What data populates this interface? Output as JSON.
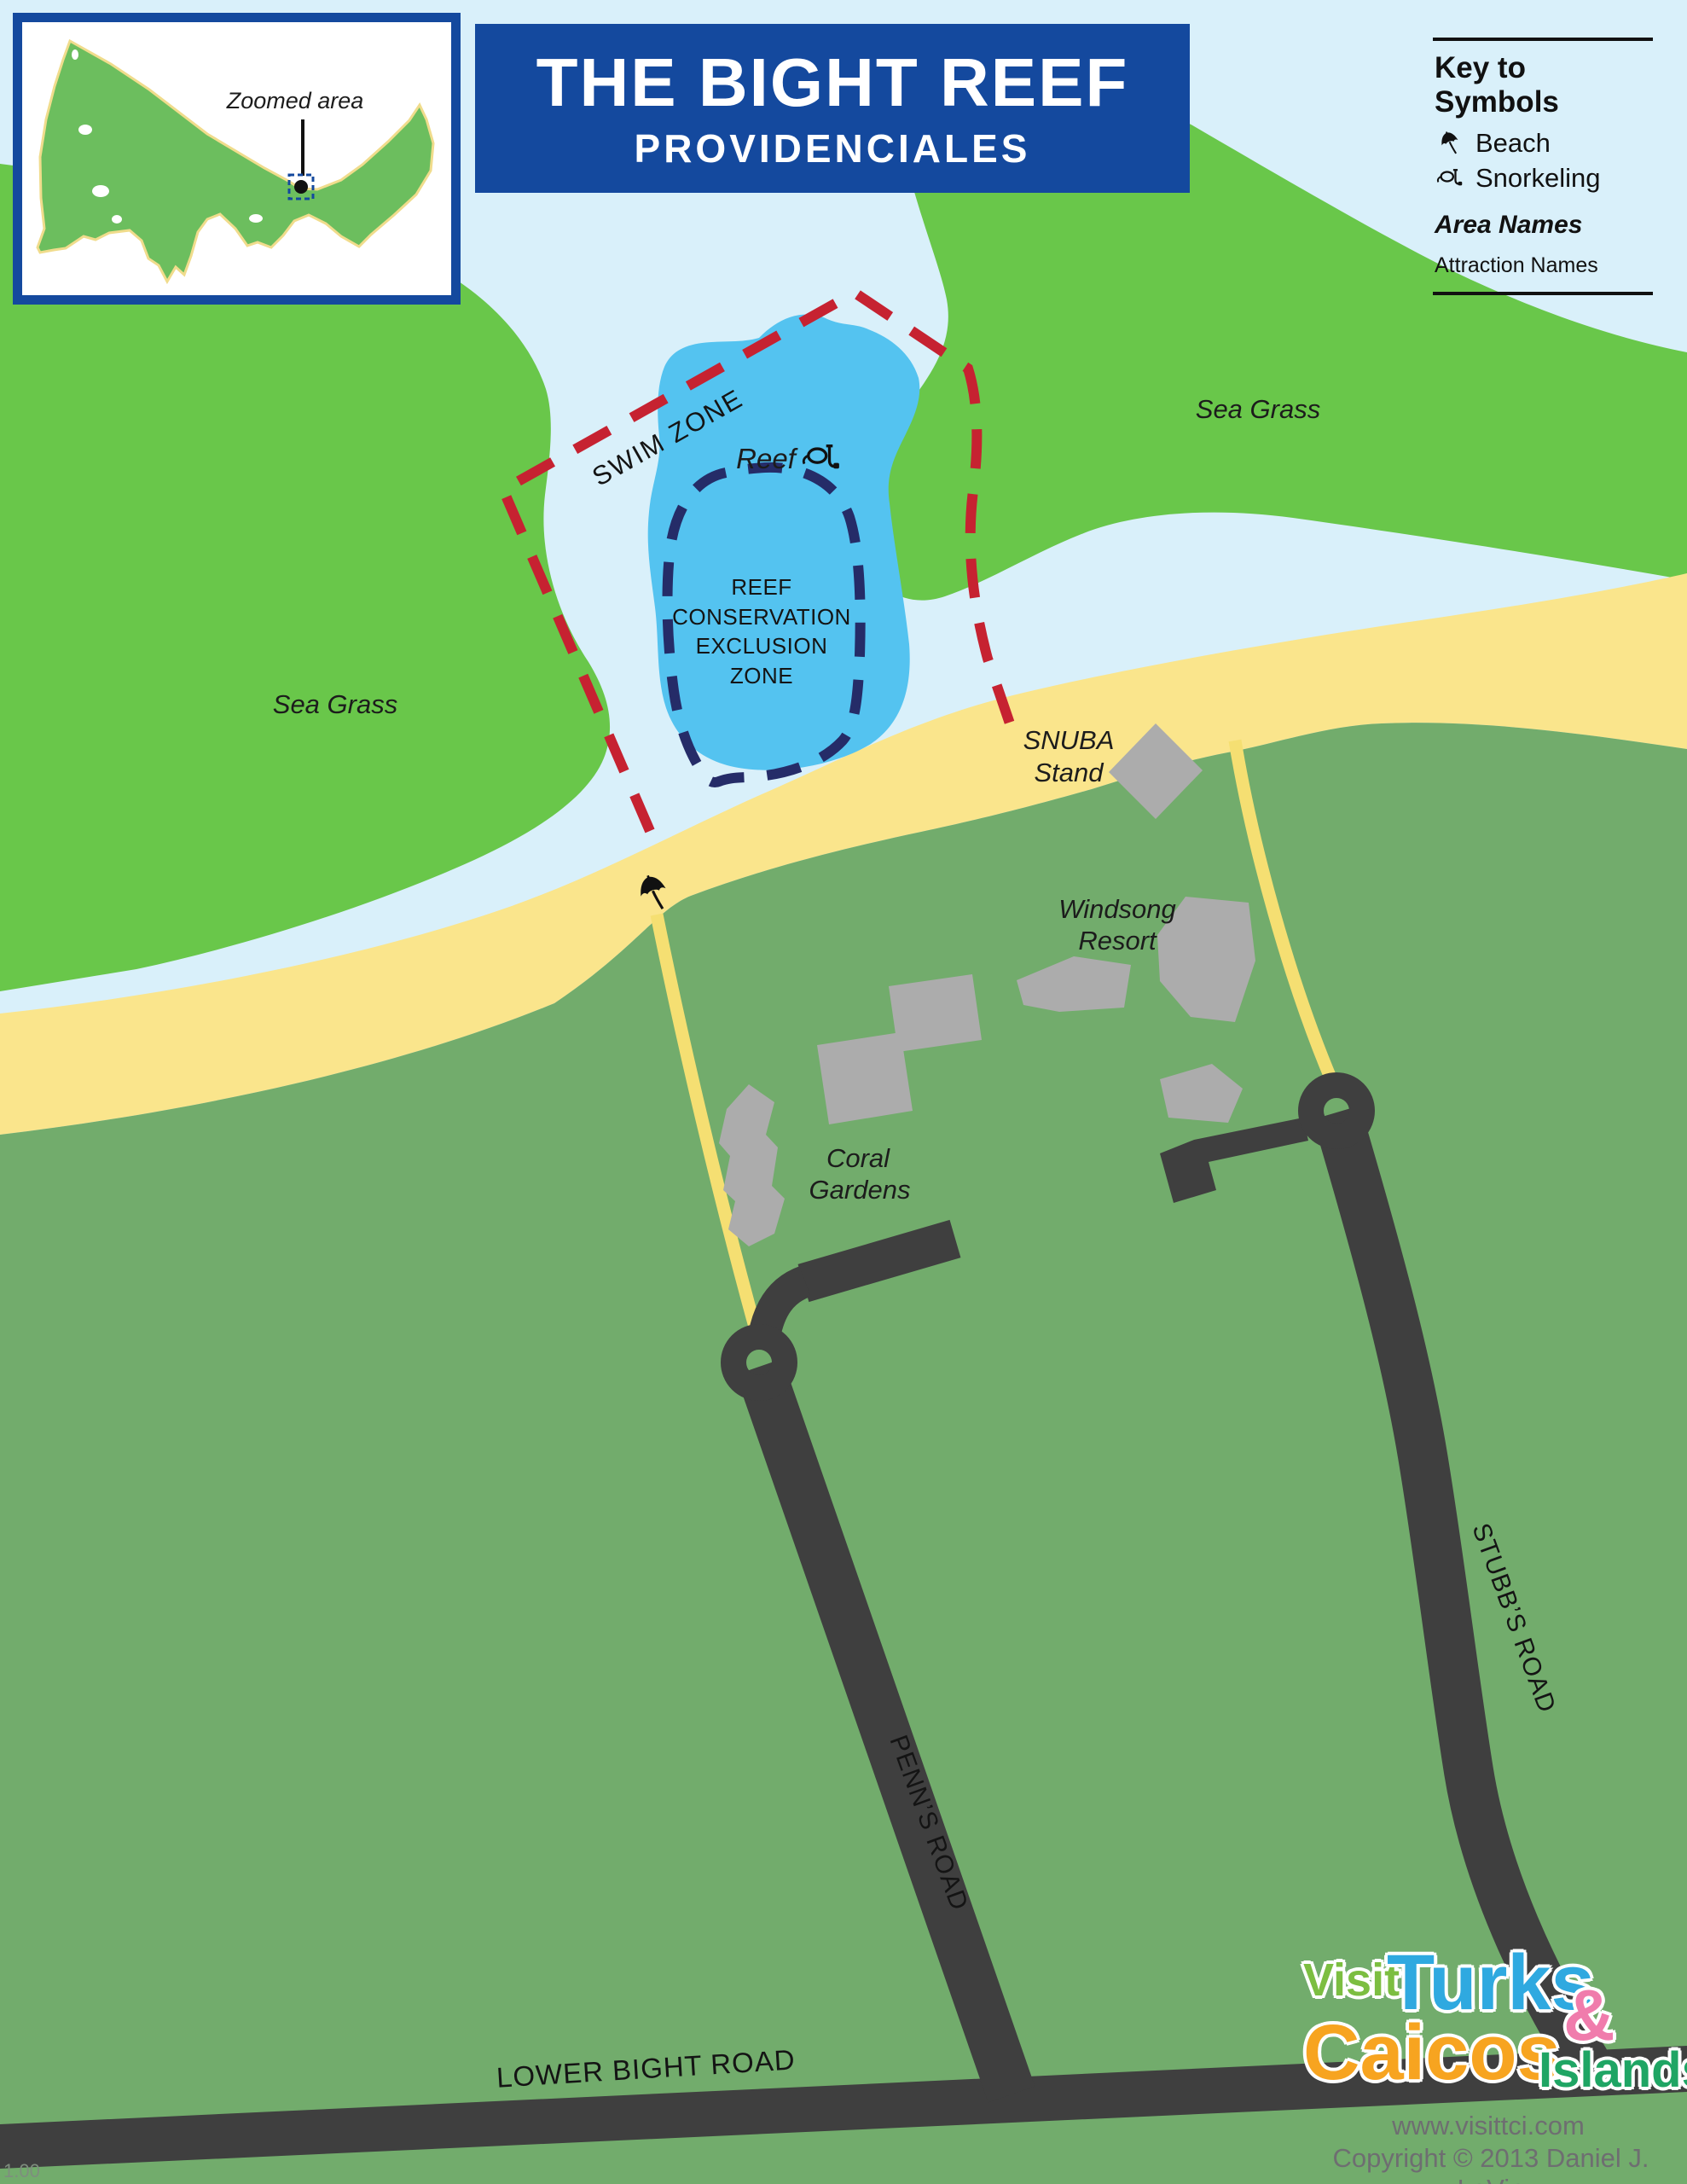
{
  "title": {
    "main": "THE BIGHT REEF",
    "subtitle": "PROVIDENCIALES"
  },
  "inset": {
    "label": "Zoomed area"
  },
  "legend": {
    "title": "Key to Symbols",
    "beach_label": "Beach",
    "snorkeling_label": "Snorkeling",
    "area_names_label": "Area Names",
    "attraction_names_label": "Attraction Names"
  },
  "map": {
    "sea_grass_left": "Sea Grass",
    "sea_grass_right": "Sea Grass",
    "swim_zone": "SWIM ZONE",
    "reef_label": "Reef",
    "conservation": {
      "line1": "REEF",
      "line2": "CONSERVATION",
      "line3": "EXCLUSION",
      "line4": "ZONE"
    },
    "snuba": {
      "line1": "SNUBA",
      "line2": "Stand"
    },
    "windsong": {
      "line1": "Windsong",
      "line2": "Resort"
    },
    "coral": {
      "line1": "Coral",
      "line2": "Gardens"
    },
    "roads": {
      "stubbs": "STUBB’S ROAD",
      "penns": "PENN’S ROAD",
      "lower_bight": "LOWER BIGHT ROAD"
    }
  },
  "branding": {
    "visit": "Visit",
    "turks": "Turks",
    "ampersand": "&",
    "caicos": "Caicos",
    "islands": "Islands",
    "registered": "®",
    "website": "www.visittci.com",
    "copyright": "Copyright © 2013 Daniel J. LeVin"
  },
  "misc": {
    "version": "1.00"
  },
  "colors": {
    "water": "#D9F0FA",
    "sea_grass_green": "#69C74A",
    "land_green": "#72AC6C",
    "beach_sand": "#FAE58C",
    "reef_blue": "#54C3F0",
    "swim_zone_red": "#C62231",
    "conservation_navy": "#252C68",
    "road_dark": "#3F3F3F",
    "building_gray": "#ACACAC",
    "title_blue": "#14499E",
    "path_yellow": "#F5DF72"
  }
}
